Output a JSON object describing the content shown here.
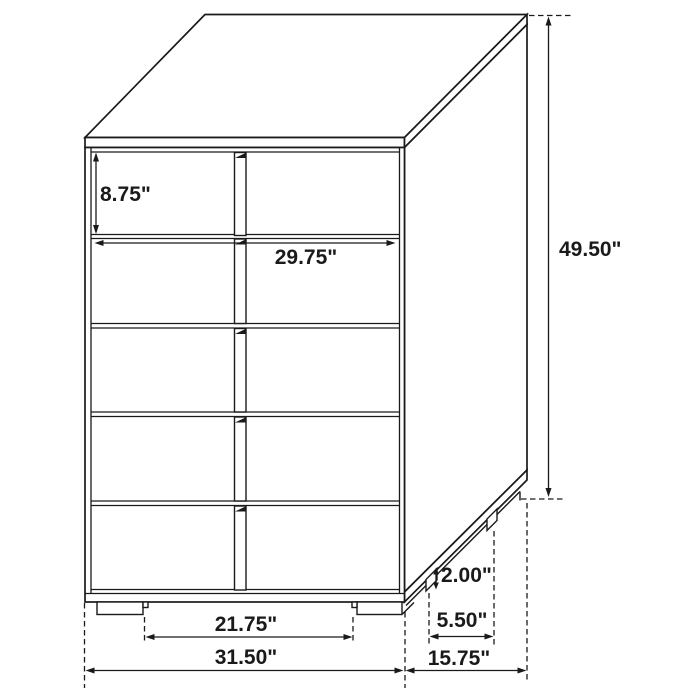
{
  "diagram": {
    "description": "Isometric line drawing of a five-drawer chest with dimension annotations",
    "colors": {
      "line": "#1a1a1a",
      "background": "#ffffff"
    },
    "labels": {
      "drawer_height": "8.75\"",
      "drawer_width": "29.75\"",
      "overall_height": "49.50\"",
      "base_height": "2.00\"",
      "side_leg_spacing": "5.50\"",
      "front_leg_spacing": "21.75\"",
      "overall_width": "31.50\"",
      "overall_depth": "15.75\""
    }
  }
}
